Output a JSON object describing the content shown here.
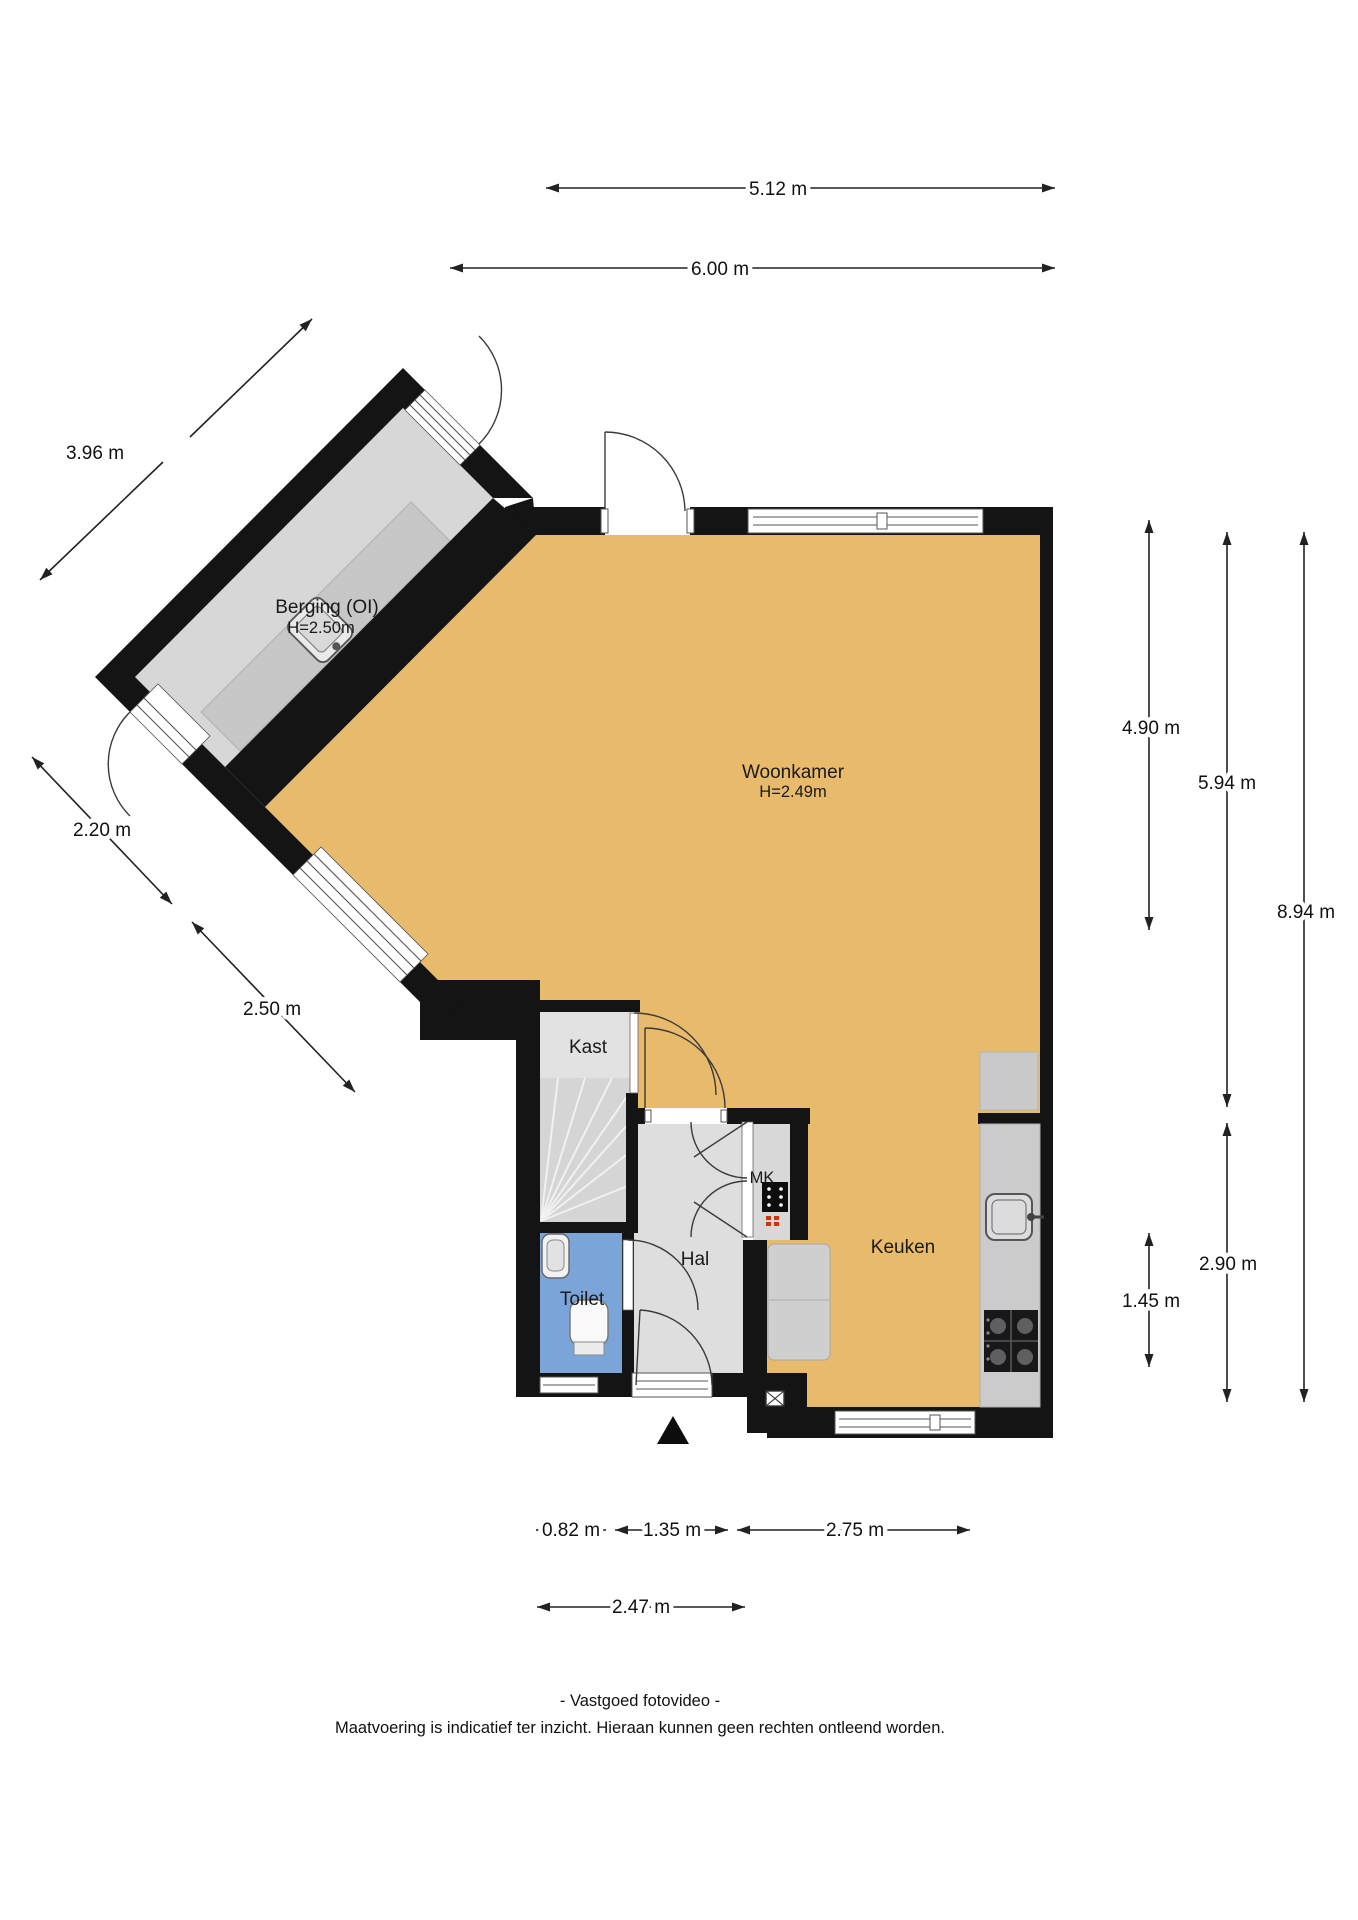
{
  "rooms": {
    "berging": {
      "label": "Berging (OI)",
      "height": "H=2.50m"
    },
    "woonkamer": {
      "label": "Woonkamer",
      "height": "H=2.49m"
    },
    "kast": {
      "label": "Kast"
    },
    "hal": {
      "label": "Hal"
    },
    "toilet": {
      "label": "Toilet"
    },
    "mk": {
      "label": "MK"
    },
    "keuken": {
      "label": "Keuken"
    }
  },
  "dimensions": {
    "width_top_inner": "5.12 m",
    "width_top_outer": "6.00 m",
    "berging_nw": "3.96 m",
    "berging_sw": "2.20 m",
    "woonkamer_sw": "2.50 m",
    "right_woonkamer": "4.90 m",
    "right_middle": "5.94 m",
    "right_total": "8.94 m",
    "right_keuken": "2.90 m",
    "right_keuken_half": "1.45 m",
    "bottom_toilet": "0.82 m",
    "bottom_hal": "1.35 m",
    "bottom_keuken": "2.75 m",
    "bottom_entrance": "2.47 m"
  },
  "footer": {
    "credit": "- Vastgoed fotovideo -",
    "disclaimer": "Maatvoering is indicatief ter inzicht. Hieraan kunnen geen rechten ontleend worden."
  },
  "colors": {
    "floor_main": "#e8ba6c",
    "floor_berging": "#d7d7d7",
    "floor_hall": "#dedede",
    "floor_toilet": "#7ba5d8",
    "wall": "#141414"
  },
  "icons": [
    "sink-icon",
    "stove-icon",
    "toilet-icon",
    "fusebox-icon",
    "vent-icon",
    "entrance-arrow-icon"
  ]
}
